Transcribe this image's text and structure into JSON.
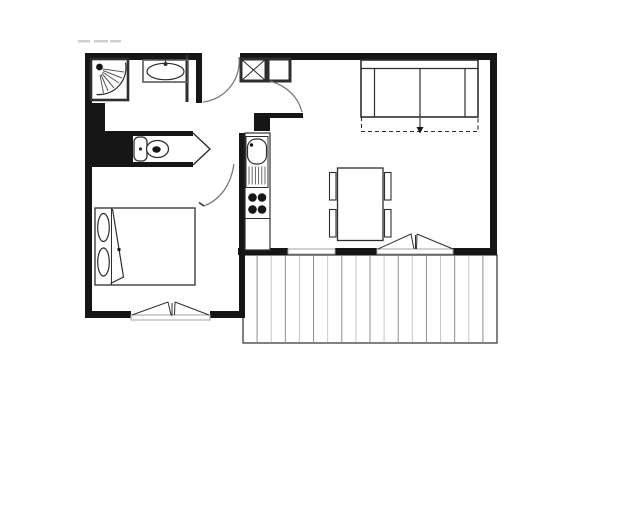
{
  "page": {
    "title": "Apartment floor plan",
    "kind": "architectural-floor-plan",
    "visible_text": []
  },
  "colors": {
    "bg": "#ffffff",
    "wall": "#161616",
    "line": "#2e2e2e",
    "thin": "#5a5a5a",
    "arc": "#767676",
    "sill": "#a3a3a3",
    "deck_dark": "#8e8e8e",
    "deck_light": "#c7c7c7",
    "artifact": "#cfcfcf"
  },
  "balcony": {
    "board_count": 18,
    "decking_orientation": "vertical"
  },
  "rooms": [
    "bathroom",
    "toilet",
    "entrance-hall",
    "bedroom",
    "kitchen",
    "living-room",
    "balcony"
  ],
  "fixtures": [
    {
      "name": "shower",
      "room": "bathroom"
    },
    {
      "name": "washbasin",
      "room": "bathroom"
    },
    {
      "name": "toilet",
      "room": "toilet"
    },
    {
      "name": "wardrobe-x-box",
      "room": "entrance-hall"
    },
    {
      "name": "closet-box",
      "room": "entrance-hall"
    },
    {
      "name": "kitchen-sink",
      "room": "kitchen"
    },
    {
      "name": "hob-4-burners",
      "room": "kitchen"
    },
    {
      "name": "double-bed",
      "pillows": 2,
      "room": "bedroom"
    },
    {
      "name": "sofa-bed",
      "room": "living-room"
    },
    {
      "name": "dining-table",
      "room": "living-room"
    },
    {
      "name": "chairs",
      "count": 4,
      "room": "living-room"
    },
    {
      "name": "decking",
      "room": "balcony"
    }
  ],
  "openings": [
    {
      "name": "entrance-door",
      "type": "swing-door"
    },
    {
      "name": "living-room-door",
      "type": "swing-door"
    },
    {
      "name": "bedroom-door",
      "type": "swing-door"
    },
    {
      "name": "toilet-door",
      "type": "wedge"
    },
    {
      "name": "bedroom-window",
      "type": "double-casement"
    },
    {
      "name": "living-room-window",
      "type": "fixed"
    },
    {
      "name": "balcony-door",
      "type": "french-window"
    }
  ]
}
